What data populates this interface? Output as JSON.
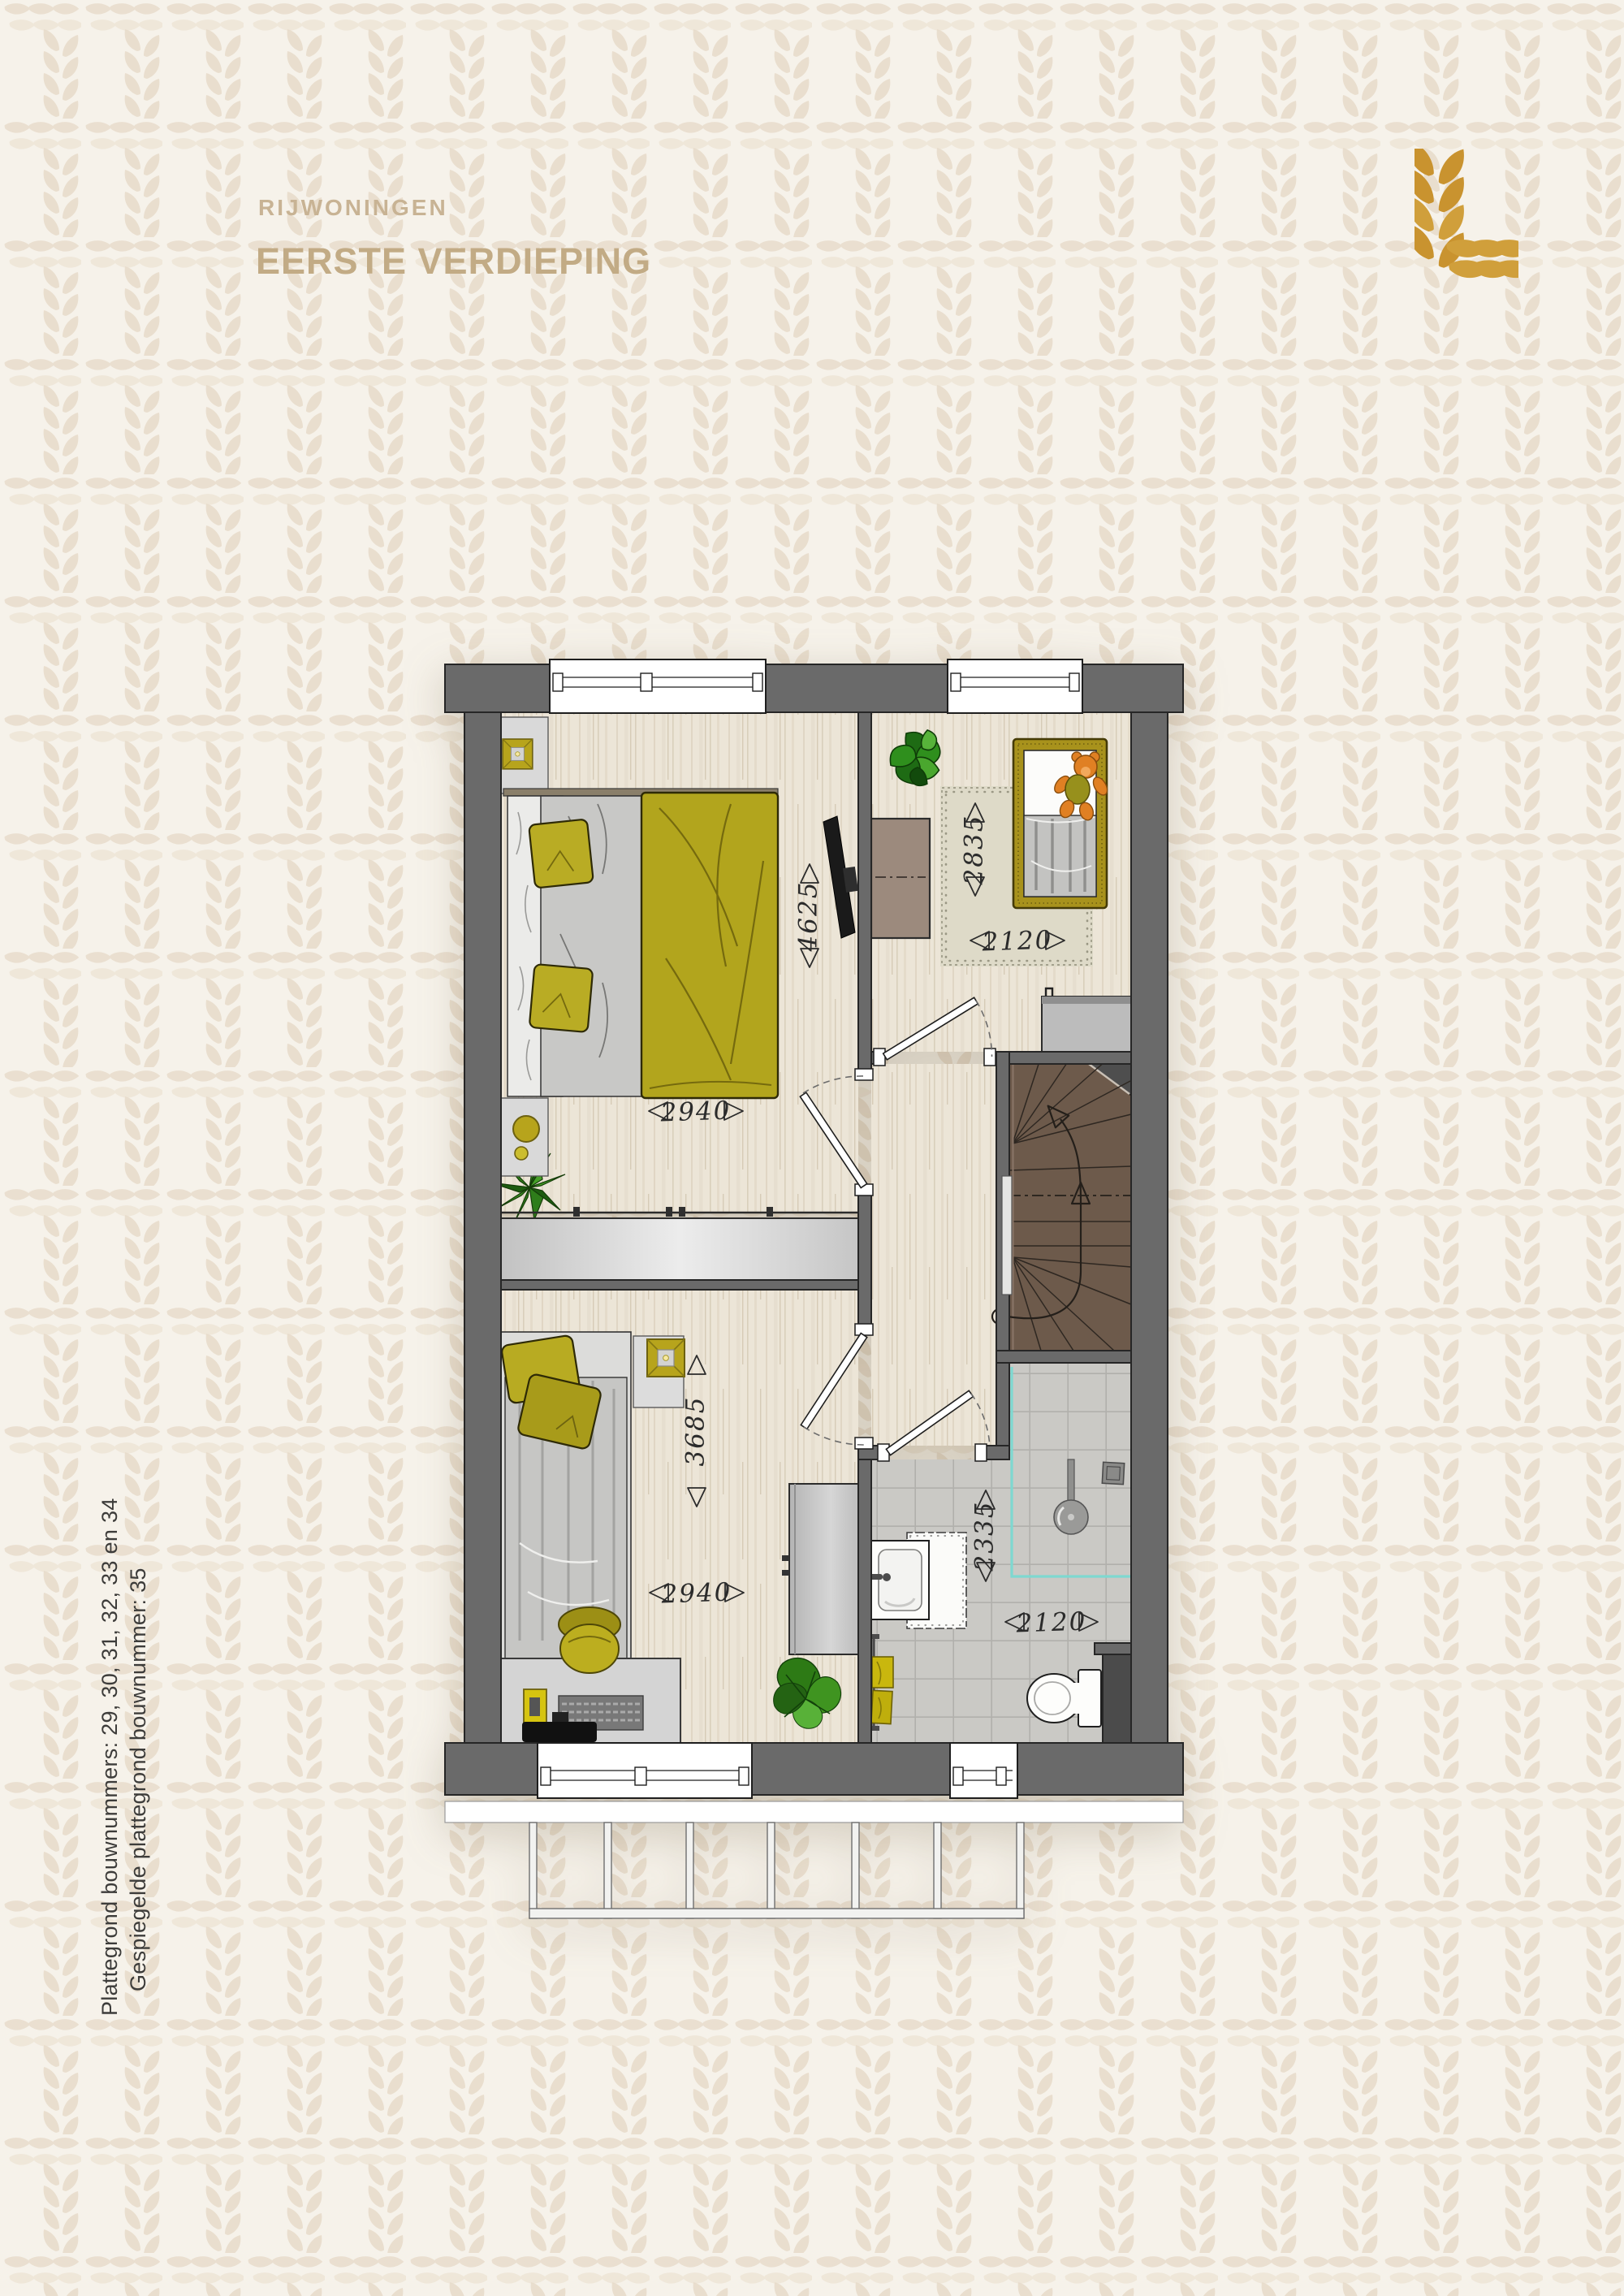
{
  "header": {
    "category": "RIJWONINGEN",
    "title": "EERSTE VERDIEPING"
  },
  "side_note": {
    "line1": "Plattegrond bouwnummers: 29, 30, 31, 32, 33 en 34",
    "line2": "Gespiegelde plattegrond bouwnummer: 35"
  },
  "logo": {
    "icon": "wheat-grain-l-mark",
    "color": "#c9932f"
  },
  "floor_plan": {
    "dimensions": {
      "master_bedroom": {
        "depth_mm": "4625",
        "width_mm": "2940"
      },
      "child_bedroom": {
        "depth_mm": "2835",
        "width_mm": "2120"
      },
      "second_bedroom": {
        "depth_mm": "3685",
        "width_mm": "2940"
      },
      "bathroom": {
        "depth_mm": "2335",
        "width_mm": "2120"
      }
    }
  },
  "colors": {
    "background": "#f6f2ea",
    "pattern_leaf": "#e8dccb",
    "title_tan": "#c2ab85",
    "accent_gold": "#c9932f",
    "wall_gray": "#6a6a6a",
    "olive": "#b2a51d",
    "stairs_brown": "#6d5a4b",
    "shower_teal": "#7ed8d0",
    "wood_floor": "#ece5d7",
    "tile_gray": "#cac9c5"
  }
}
